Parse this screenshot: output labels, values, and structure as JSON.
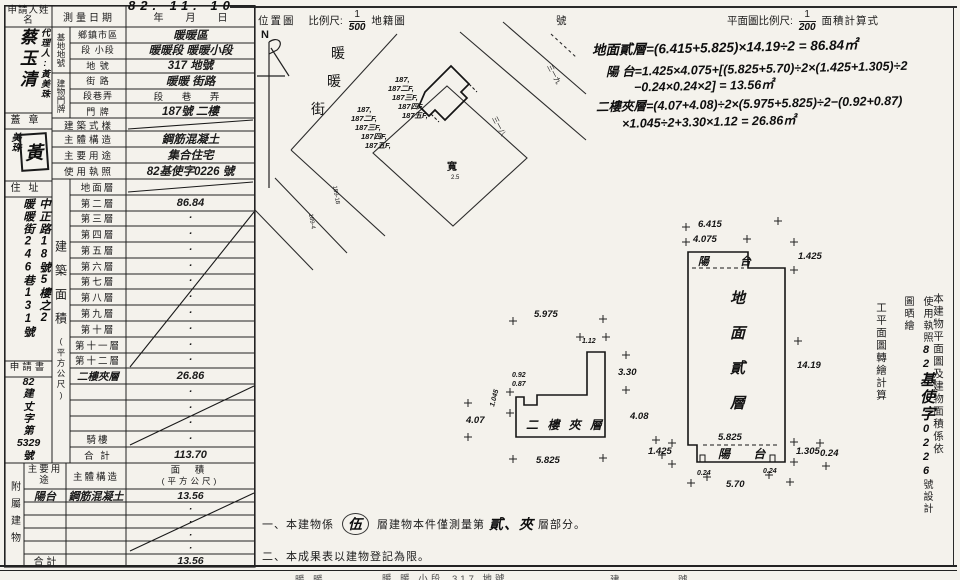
{
  "form": {
    "date_stamp": "82. 11. 10",
    "survey": {
      "label": "測量日期",
      "year": "年",
      "month": "月",
      "day": "日"
    },
    "applicant": {
      "label": "申請人姓名",
      "name": "蔡玉清",
      "agent": "代理人:黃美珠",
      "seal_label": "蓋章",
      "seal_char": "黃",
      "seal_note": "美珠",
      "address_label": "住址",
      "address1": "中正路18號5樓之2",
      "address2": "暖暖街246巷131號",
      "application_label": "申請書",
      "application_lines": [
        "82",
        "建",
        "丈",
        "字",
        "第",
        "5329",
        "號"
      ]
    },
    "land": {
      "group": "基地地號",
      "rows": [
        {
          "label": "鄉鎮市區",
          "value": "暖暖區"
        },
        {
          "label": "段 小段",
          "value": "暖暖段 暖暖小段"
        },
        {
          "label": "地 號",
          "value": "317 地號"
        }
      ]
    },
    "door": {
      "group": "建物門牌",
      "rows": [
        {
          "label": "街 路",
          "value": "暖暖 街路"
        },
        {
          "label": "段巷弄",
          "value": "段 巷 弄"
        },
        {
          "label": "門 牌",
          "value": "187號 二樓"
        }
      ]
    },
    "info": {
      "rows": [
        {
          "label": "建築式樣",
          "value": ""
        },
        {
          "label": "主體構造",
          "value": "鋼筋混凝土"
        },
        {
          "label": "主要用途",
          "value": "集合住宅"
        },
        {
          "label": "使用執照",
          "value": "82基使字0226 號"
        }
      ]
    },
    "area": {
      "group_main": "建築面積",
      "group_unit": "(平方公尺)",
      "rows": [
        {
          "label": "地面層",
          "value": ""
        },
        {
          "label": "第二層",
          "value": "86.84"
        },
        {
          "label": "第三層",
          "value": "·"
        },
        {
          "label": "第四層",
          "value": "·"
        },
        {
          "label": "第五層",
          "value": "·"
        },
        {
          "label": "第六層",
          "value": "·"
        },
        {
          "label": "第七層",
          "value": "·"
        },
        {
          "label": "第八層",
          "value": "·"
        },
        {
          "label": "第九層",
          "value": "·"
        },
        {
          "label": "第十層",
          "value": "·"
        },
        {
          "label": "第十一層",
          "value": "·"
        },
        {
          "label": "第十二層",
          "value": "·"
        },
        {
          "label": "二樓夾層",
          "value": "26.86"
        },
        {
          "label": "",
          "value": "·"
        },
        {
          "label": "",
          "value": "·"
        },
        {
          "label": "",
          "value": "·"
        },
        {
          "label": "騎樓",
          "value": "·"
        },
        {
          "label": "合 計",
          "value": "113.70"
        }
      ]
    },
    "annex": {
      "group": "附屬建物",
      "h_use": "主要用途",
      "h_structure": "主體構造",
      "h_area1": "面 積",
      "h_area2": "(平方公尺)",
      "rows": [
        {
          "use": "陽台",
          "structure": "鋼筋混凝土",
          "area": "13.56"
        },
        {
          "use": "",
          "structure": "",
          "area": "·"
        },
        {
          "use": "",
          "structure": "",
          "area": "·"
        },
        {
          "use": "",
          "structure": "",
          "area": "·"
        },
        {
          "use": "",
          "structure": "",
          "area": "·"
        },
        {
          "use": "合 計",
          "structure": "",
          "area": "13.56"
        }
      ]
    }
  },
  "map": {
    "title": "位置圖",
    "scale_label": "比例尺:",
    "num": "1",
    "den": "500",
    "kind": "地籍圖",
    "no_suffix": "號",
    "north": "N",
    "street1": "暖",
    "street2": "暖",
    "street3": "街",
    "cluster1": [
      "187,",
      "187二F,",
      "187三F,",
      "187四F,",
      "187五F,"
    ],
    "cluster2": [
      "187,",
      "187二F,",
      "187三F,",
      "187四F,",
      "187五F,"
    ],
    "labels": {
      "a": "三一九",
      "b": "三一八",
      "c": "寬",
      "c2": "2.5",
      "d": "189-18",
      "e": "189-4"
    }
  },
  "plans": {
    "scale_label": "平面圖比例尺:",
    "num": "1",
    "den": "200",
    "calc_label": "面積計算式",
    "calc": {
      "l1": "地面貳層=(6.415+5.825)×14.19÷2 = 86.84㎡",
      "l2": "陽 台=1.425×4.075+[(5.825+5.70)÷2×(1.425+1.305)÷2",
      "l3": "−0.24×0.24×2] = 13.56㎡",
      "l4": "二樓夾層=(4.07+4.08)÷2×(5.975+5.825)÷2−(0.92+0.87)",
      "l5": "×1.045÷2+3.30×1.12 = 26.86㎡"
    },
    "main": {
      "c1": "地",
      "c2": "面",
      "c3": "貳",
      "c4": "層",
      "balcony_top": "陽 台",
      "balcony_bottom": "陽  台",
      "d_top": "6.415",
      "d_top2": "4.075",
      "d_rt": "1.425",
      "d_right": "14.19",
      "d_ib": "5.825",
      "d_lb": "1.425",
      "d_rb": "1.305",
      "d_rb2": "0.24",
      "d_b": "5.70",
      "d_bt1": "0.24",
      "d_bt2": "0.24"
    },
    "mezz": {
      "label": "二 樓 夾 層",
      "d_top": "5.975",
      "d_step": "1.12",
      "d_ru": "3.30",
      "d_rl": "4.08",
      "d_l": "4.07",
      "d_notch": "1.045",
      "d_n1": "0.92",
      "d_n2": "0.87",
      "d_b": "5.825"
    }
  },
  "sidenote": {
    "c1": "本建物平面圖及建物面積係依",
    "c2a": "使用執照",
    "c2b": "82",
    "c2c": "基使字",
    "c2d": "0226",
    "c2e": "號設計圖晒繪",
    "c3": "工平面圖轉繪計算"
  },
  "notes": {
    "n1a": "一、本建物係",
    "n1b": "伍",
    "n1c": "層建物本件僅測量第",
    "n1d": "貳、夾",
    "n1e": "層部分。",
    "n2": "二、本成果表以建物登記為限。"
  },
  "strip": {
    "f1": "暖 暖",
    "f2": "暖 暖 小段",
    "f3": "317  地號",
    "f4": "建",
    "f5": "號"
  }
}
